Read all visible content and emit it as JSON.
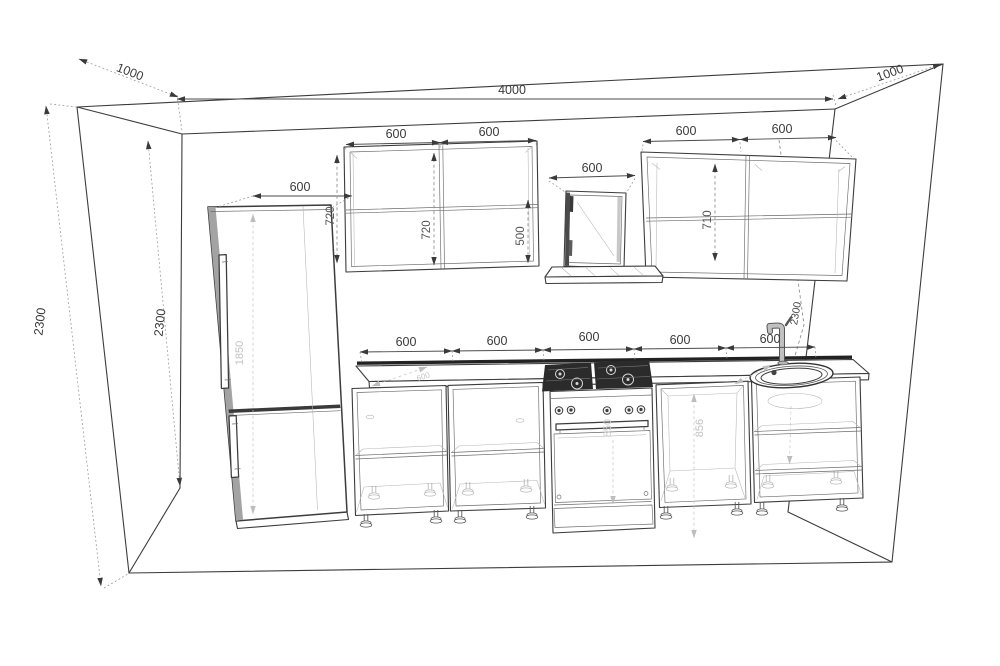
{
  "drawing": {
    "type": "kitchen-elevation-technical-drawing",
    "colors": {
      "line": "#3c3c3c",
      "dim_text": "#3a3a3a",
      "faint_text": "#c2c2c2",
      "hob_dark": "#2b2b2b",
      "metal": "#b9b9b9",
      "backsplash": "#222222"
    },
    "labels": {
      "room_width": "4000",
      "side_depth_left": "1000",
      "side_depth_right": "1000",
      "room_height_outer": "2300",
      "room_height_inner": "2300",
      "room_height_right": "2300",
      "fridge_width": "600",
      "fridge_height": "1850",
      "wall_cab1_width": "600",
      "wall_cab2_width": "600",
      "wall_cab3_width": "600",
      "wall_cab4_width": "600",
      "hood_width": "600",
      "hood_cab_height": "500",
      "wall_cab_height_a": "720",
      "wall_cab_height_b": "720",
      "wall_cab_height_c": "710",
      "base_cab1_width": "600",
      "base_cab2_width": "600",
      "base_cab3_width": "600",
      "base_cab4_width": "600",
      "base_cab5_width": "600",
      "base_cab_height": "856",
      "stove_height": "850",
      "counter_depth": "600"
    }
  }
}
